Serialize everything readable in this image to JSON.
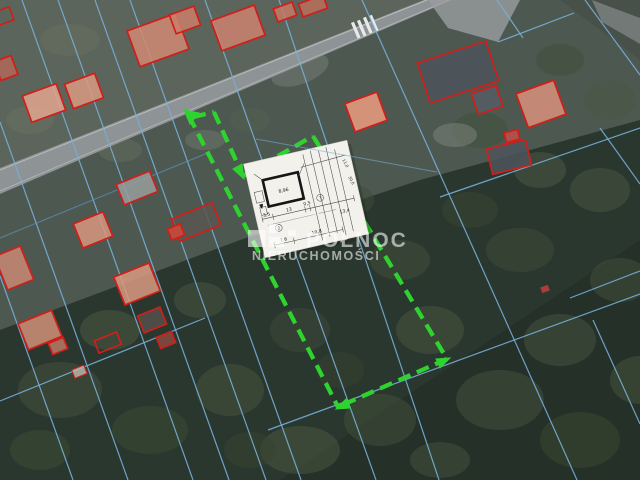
{
  "map": {
    "type": "aerial-cadastral",
    "colors": {
      "plot_outline": "#2fd32f",
      "parcel_lines": "#79aed7",
      "building_outline": "#cf1f1a",
      "road": "#8e9396",
      "forest": "#2a362e",
      "paper": "#f3f1ec",
      "watermark": "#ffffff"
    },
    "plot": {
      "edges": {
        "left": "189,116 338,407",
        "neck_top": "193,117 214,112",
        "neck_right": "214,112 243,176",
        "main_top": "243,176 313,136",
        "right": "313,136 447,359",
        "bottom": "447,359 338,407"
      },
      "arrows": {
        "road_end": "184,110 199,113 190,124",
        "neck_end": "244,179 242,164 233,169",
        "bottom_left": "336,409 346,399 350,408",
        "bottom_right": "450,358 440,368 436,359"
      }
    }
  },
  "watermark": {
    "line1": "PÓŁNOC",
    "line2": "NIERUCHOMOŚCI"
  },
  "sketch": {
    "building_dim": "8,96",
    "dims_top_1": "3,5",
    "dims_top_2": "13",
    "dims_top_3": "0,5",
    "dims_bottom_1": "7,6",
    "dims_bottom_2": "10,8",
    "dim_right": "13,4",
    "dim_side_1": "11,0",
    "dim_side_2": "30,6",
    "parcel_no_1": "2",
    "parcel_no_2": "7"
  }
}
